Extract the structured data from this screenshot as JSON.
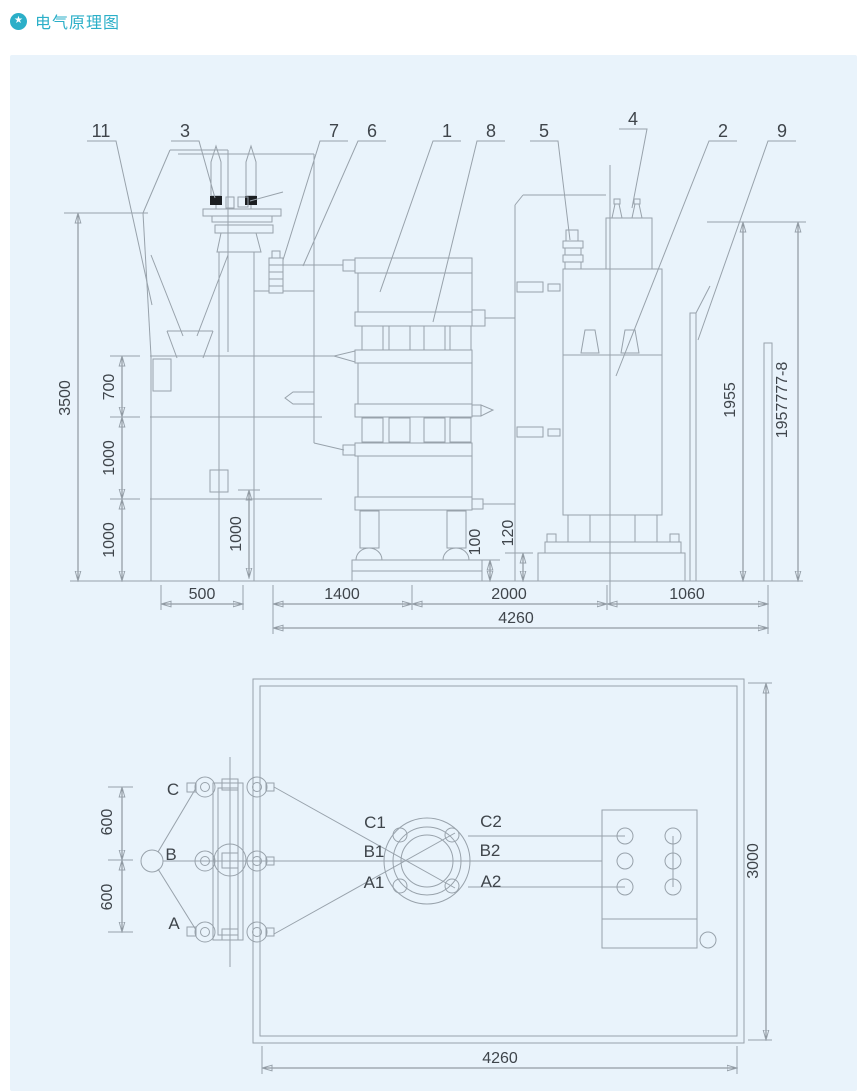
{
  "header": {
    "title": "电气原理图",
    "icon": "star-badge-icon",
    "accent_color": "#2bafc8",
    "star_glyph": "★"
  },
  "elevation": {
    "callouts": {
      "c1": "1",
      "c2": "2",
      "c3": "3",
      "c4": "4",
      "c5": "5",
      "c6": "6",
      "c7": "7",
      "c8": "8",
      "c9": "9",
      "c11": "11"
    },
    "dims": {
      "height_total": "3500",
      "seg_700": "700",
      "seg_1000a": "1000",
      "seg_1000b": "1000",
      "inner_1000": "1000",
      "base_100": "100",
      "base_120": "120",
      "right_1955": "1955",
      "serial": "1957777-8",
      "w_500": "500",
      "w_1400": "1400",
      "w_2000": "2000",
      "w_1060": "1060",
      "w_total": "4260"
    }
  },
  "plan": {
    "terminals": {
      "a": "A",
      "b": "B",
      "c": "C",
      "a1": "A1",
      "b1": "B1",
      "c1": "C1",
      "a2": "A2",
      "b2": "B2",
      "c2": "C2"
    },
    "dims": {
      "d600_top": "600",
      "d600_bottom": "600",
      "d3000": "3000",
      "d4260": "4260"
    }
  }
}
